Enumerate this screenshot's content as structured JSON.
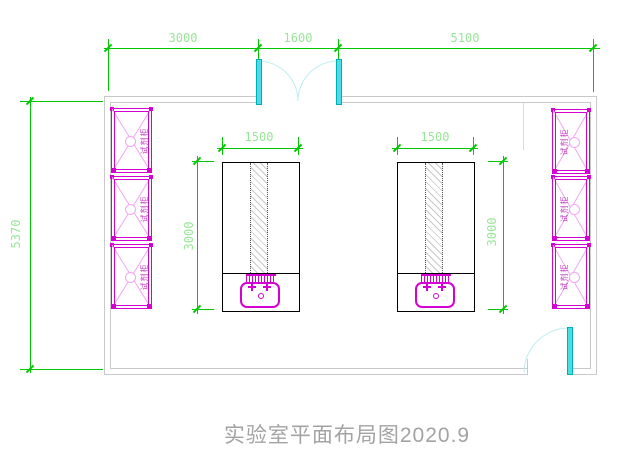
{
  "title": "实验室平面布局图2020.9",
  "dimensions": {
    "top": {
      "left": "3000",
      "middle": "1600",
      "right": "5100"
    },
    "left_wall": "5370",
    "bench_left": {
      "width": "1500",
      "height": "3000"
    },
    "bench_right": {
      "width": "1500",
      "height": "3000"
    }
  },
  "cabinets": {
    "label": "试剂柜"
  },
  "colors": {
    "dim_line": "#00C800",
    "dim_text": "#98E698",
    "wall": "#C9C9C9",
    "bench_line": "#000000",
    "cabinet": "#D400D4",
    "cabinet_light": "#F2A6F2",
    "cabinet_text": "#C23CC2",
    "door": "#4ADDE4",
    "door_edge": "#00AEB8",
    "door_arc": "#BDEDEF",
    "hatch": "#C8C8C8",
    "title_text": "#A3A3A3"
  }
}
